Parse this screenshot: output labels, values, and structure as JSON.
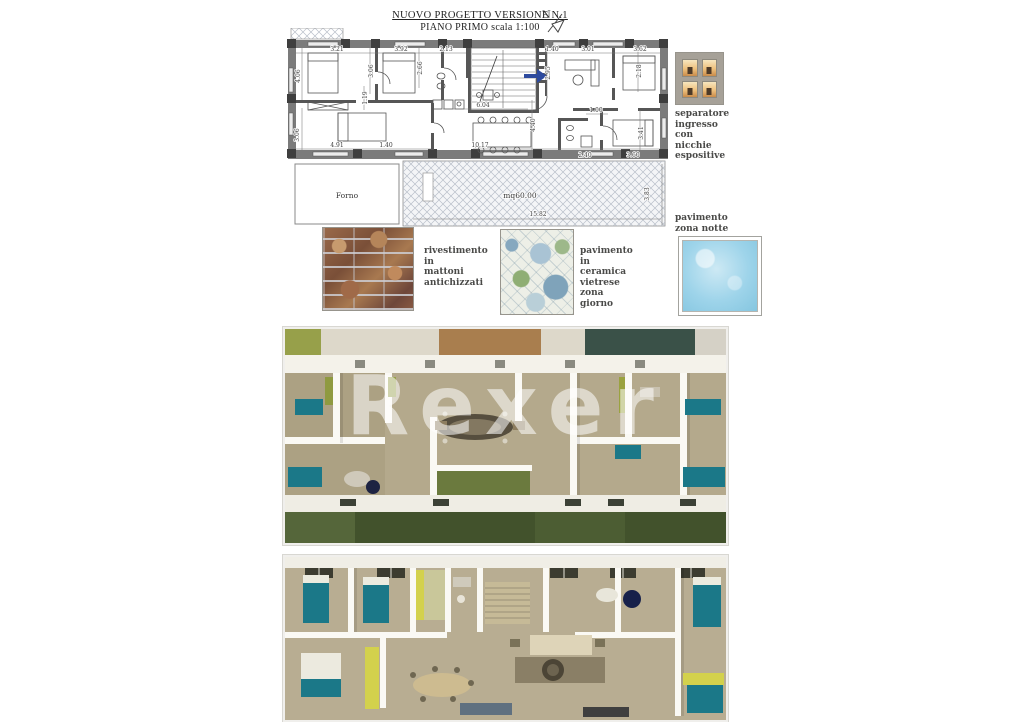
{
  "title": {
    "line1": "NUOVO PROGETTO VERSIONE N.1",
    "line2": "PIANO  PRIMO scala 1:100",
    "north": "N"
  },
  "plan": {
    "labels": {
      "forno": "Forno",
      "terrace_area": "mq60.00"
    },
    "dims": [
      "3.21",
      "3.92",
      "2.13",
      "1.40",
      "3.01",
      "3.62",
      "4.06",
      "3.06",
      "2.66",
      "2.95",
      "2.18",
      "1.19",
      "6.04",
      "1.00",
      "4.40",
      "3.41",
      "3.06",
      "4.91",
      "1.40",
      "10.17",
      "2.40",
      "3.60",
      "15.82",
      "3.83"
    ]
  },
  "legend": {
    "separator": {
      "lines": [
        "separatore",
        "ingresso",
        "con",
        "nicchie",
        "espositive"
      ]
    },
    "brick": {
      "lines": [
        "rivestimento",
        "in",
        "mattoni",
        "antichizzati"
      ]
    },
    "ceramic": {
      "lines": [
        "pavimento",
        "in",
        "ceramica",
        "vietrese",
        "zona",
        "giorno"
      ]
    },
    "notte": {
      "lines": [
        "pavimento",
        "zona  notte"
      ]
    }
  },
  "watermark": {
    "text": "Rexer"
  },
  "colors": {
    "wall_gray": "#6f6f6f",
    "pillar_dark": "#3e3e3e",
    "arrow_blue": "#2d4a9e",
    "pool_blue": "#9ed4ea",
    "brick_brown": "#8a5a43",
    "teal_bed": "#1b7888",
    "olive": "#97a04a",
    "yellow": "#d3d14c",
    "floor_tan": "#b4a98c",
    "grass_green": "#42522c"
  }
}
